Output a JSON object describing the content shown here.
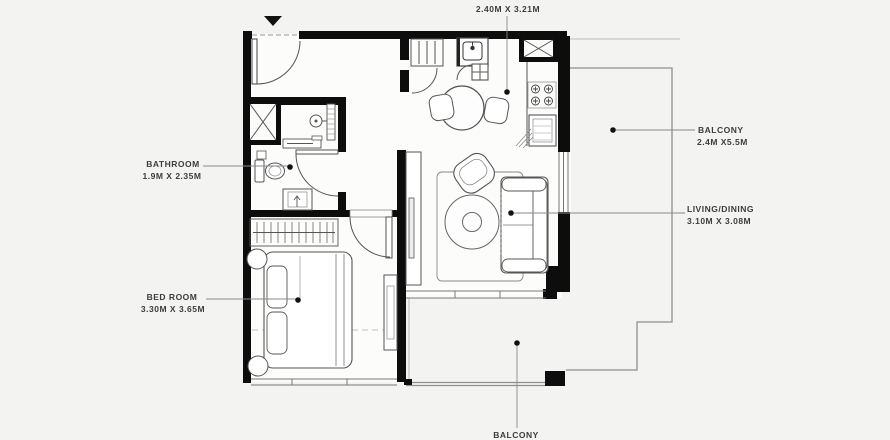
{
  "plan": {
    "rooms": {
      "kitchen": {
        "dim": "2.40M X 3.21M"
      },
      "bathroom": {
        "name": "BATHROOM",
        "dim": "1.9M X 2.35M"
      },
      "bedroom": {
        "name": "BED ROOM",
        "dim": "3.30M X 3.65M"
      },
      "living": {
        "name": "LIVING/DINING",
        "dim": "3.10M X 3.08M"
      },
      "balcony_right": {
        "name": "BALCONY",
        "dim": "2.4M X5.5M"
      },
      "balcony_bottom": {
        "name": "BALCONY"
      }
    },
    "colors": {
      "wall": "#0d0d0d",
      "background": "#f3f3f1",
      "floor": "#fcfcfb",
      "furniture_line": "#4a4a4a",
      "label_text": "#3d3d3d"
    }
  }
}
